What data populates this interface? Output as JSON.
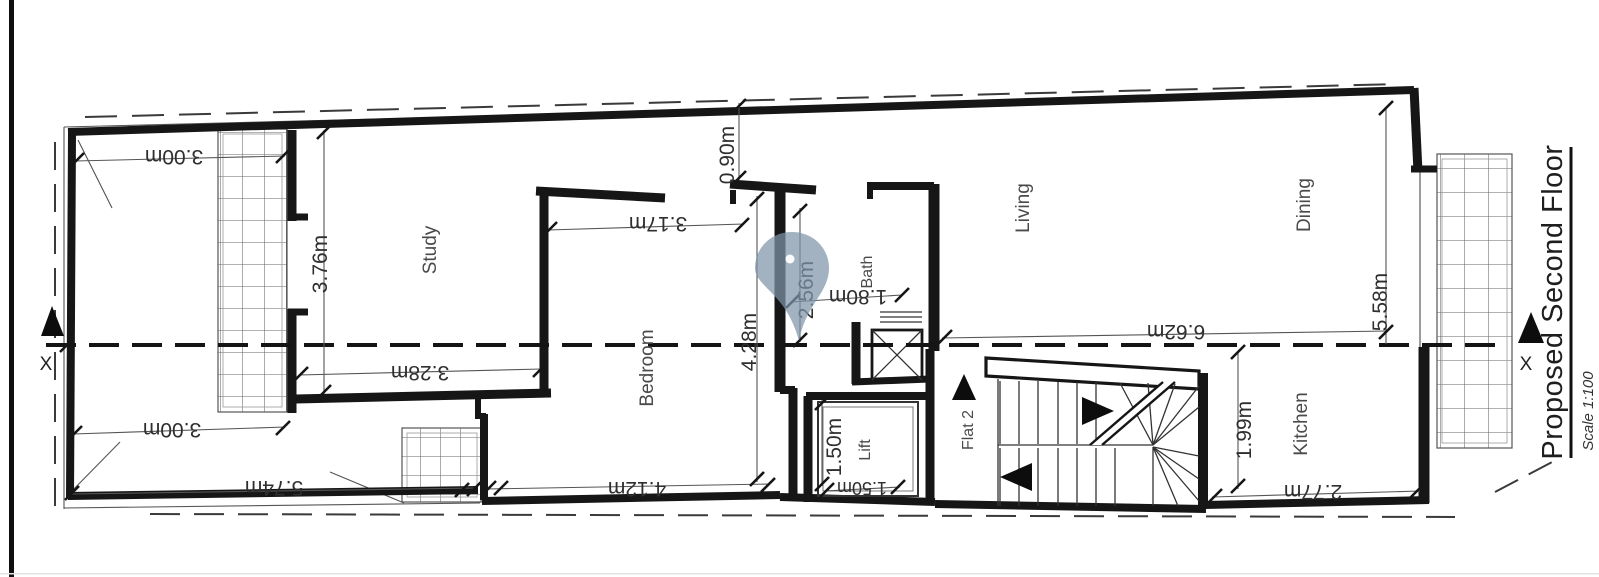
{
  "drawing": {
    "title": "Proposed Second Floor",
    "scale_note": "Scale 1:100",
    "section_marker_left": "X",
    "section_marker_right": "X",
    "rooms": {
      "study": "Study",
      "bedroom": "Bedroom",
      "bath": "Bath",
      "living": "Living",
      "dining": "Dining",
      "kitchen": "Kitchen",
      "lift": "Lift",
      "flat": "Flat 2"
    },
    "dimensions": {
      "terrace_width_top": "3.00m",
      "study_depth": "3.76m",
      "terrace_width_mid": "3.00m",
      "terrace_length": "5.74m",
      "study_width": "3.28m",
      "bedroom_width": "4.12m",
      "study_passage_width": "3.17m",
      "rear_yard_depth": "0.90m",
      "bath_length": "2.56m",
      "bedroom_depth": "4.28m",
      "bath_width": "1.80m",
      "lift_depth": "1.50m",
      "lift_width": "1.50m",
      "living_length": "6.62m",
      "living_depth": "5.58m",
      "kitchen_depth": "1.99m",
      "kitchen_width": "2.77m"
    },
    "colors": {
      "wall": "#161616",
      "dimension_text": "#2f2f2f",
      "room_text": "#4a4a4a",
      "pin_fill": "#7e94a9"
    }
  }
}
